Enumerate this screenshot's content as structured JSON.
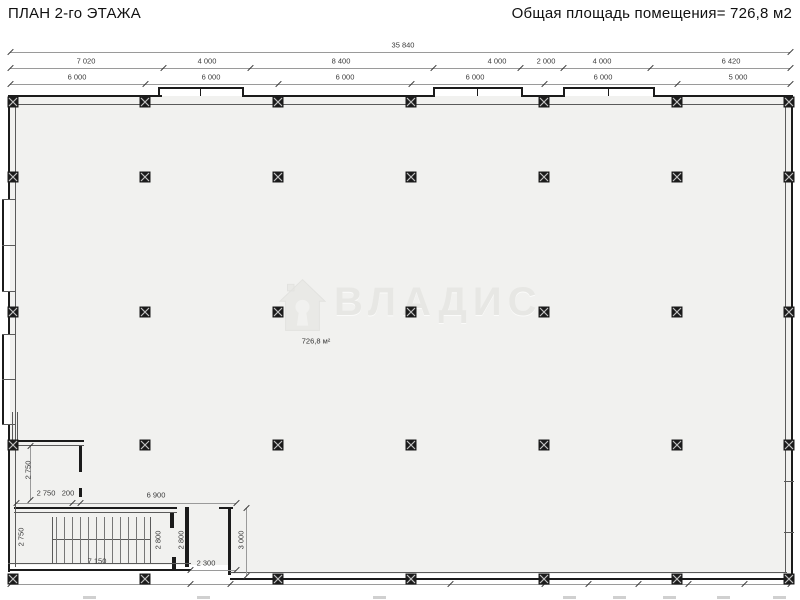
{
  "titles": {
    "left": "ПЛАН 2-го ЭТАЖА",
    "right": "Общая площадь помещения= 726,8 м2"
  },
  "watermark": {
    "brand": "ВЛАДИС",
    "icon": "house-logo-icon"
  },
  "plan": {
    "area_label": "726,8 м²",
    "overall_dimension": {
      "text": "35 840",
      "x": 403,
      "y": 45
    },
    "span_dimensions": [
      {
        "text": "7 020",
        "x": 86,
        "y": 61
      },
      {
        "text": "4 000",
        "x": 207,
        "y": 61
      },
      {
        "text": "8 400",
        "x": 341,
        "y": 61
      },
      {
        "text": "4 000",
        "x": 497,
        "y": 61
      },
      {
        "text": "2 000",
        "x": 546,
        "y": 61
      },
      {
        "text": "4 000",
        "x": 602,
        "y": 61
      },
      {
        "text": "6 420",
        "x": 731,
        "y": 61
      }
    ],
    "grid_dimensions": [
      {
        "text": "6 000",
        "x": 77,
        "y": 77
      },
      {
        "text": "6 000",
        "x": 211,
        "y": 77
      },
      {
        "text": "6 000",
        "x": 345,
        "y": 77
      },
      {
        "text": "6 000",
        "x": 475,
        "y": 77
      },
      {
        "text": "6 000",
        "x": 603,
        "y": 77
      },
      {
        "text": "5 000",
        "x": 738,
        "y": 77
      }
    ],
    "detail_dimensions": [
      {
        "text": "2 750",
        "x": 28,
        "y": 470,
        "rot": true
      },
      {
        "text": "2 750",
        "x": 46,
        "y": 493
      },
      {
        "text": "200",
        "x": 68,
        "y": 493
      },
      {
        "text": "6 900",
        "x": 156,
        "y": 495
      },
      {
        "text": "2 750",
        "x": 21,
        "y": 537,
        "rot": true
      },
      {
        "text": "2 800",
        "x": 158,
        "y": 540,
        "rot": true
      },
      {
        "text": "2 800",
        "x": 181,
        "y": 540,
        "rot": true
      },
      {
        "text": "7 150",
        "x": 97,
        "y": 561
      },
      {
        "text": "2 300",
        "x": 206,
        "y": 563
      },
      {
        "text": "3 000",
        "x": 241,
        "y": 540,
        "rot": true
      }
    ],
    "column_grid": {
      "x": [
        13,
        145,
        278,
        411,
        544,
        677,
        789
      ],
      "y": [
        100,
        175,
        310,
        443,
        577
      ]
    }
  },
  "colors": {
    "floor": "#f1f1ef",
    "wall": "#1b1b1b",
    "dimension_line": "#9a9a9a",
    "watermark": "#e7e7e4"
  }
}
